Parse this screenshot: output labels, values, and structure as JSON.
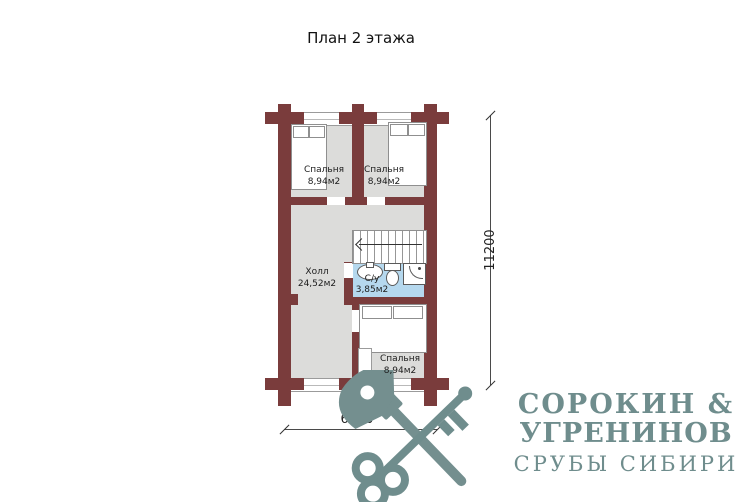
{
  "title": "План 2 этажа",
  "plan": {
    "rooms": [
      {
        "name": "bedroom-top-left",
        "label": "Спальня",
        "area": "8,94м2"
      },
      {
        "name": "bedroom-top-right",
        "label": "Спальня",
        "area": "8,94м2"
      },
      {
        "name": "hall",
        "label": "Холл",
        "area": "24,52м2"
      },
      {
        "name": "bathroom",
        "label": "С/у",
        "area": "3,85м2"
      },
      {
        "name": "bedroom-bottom",
        "label": "Спальня",
        "area": "8,94м2"
      }
    ],
    "dimensions": {
      "height": "11200",
      "width": "6000"
    },
    "colors": {
      "wall": "#7a3c3c",
      "floor": "#dcdcda",
      "bathroom_floor": "#b5d8ee"
    }
  },
  "logo": {
    "line1": "СОРОКИН &",
    "line2": "УГРЕНИНОВ",
    "line3": "СРУБЫ СИБИРИ",
    "color": "#6f8d8d",
    "emblem": "crossed-axe-and-key"
  }
}
